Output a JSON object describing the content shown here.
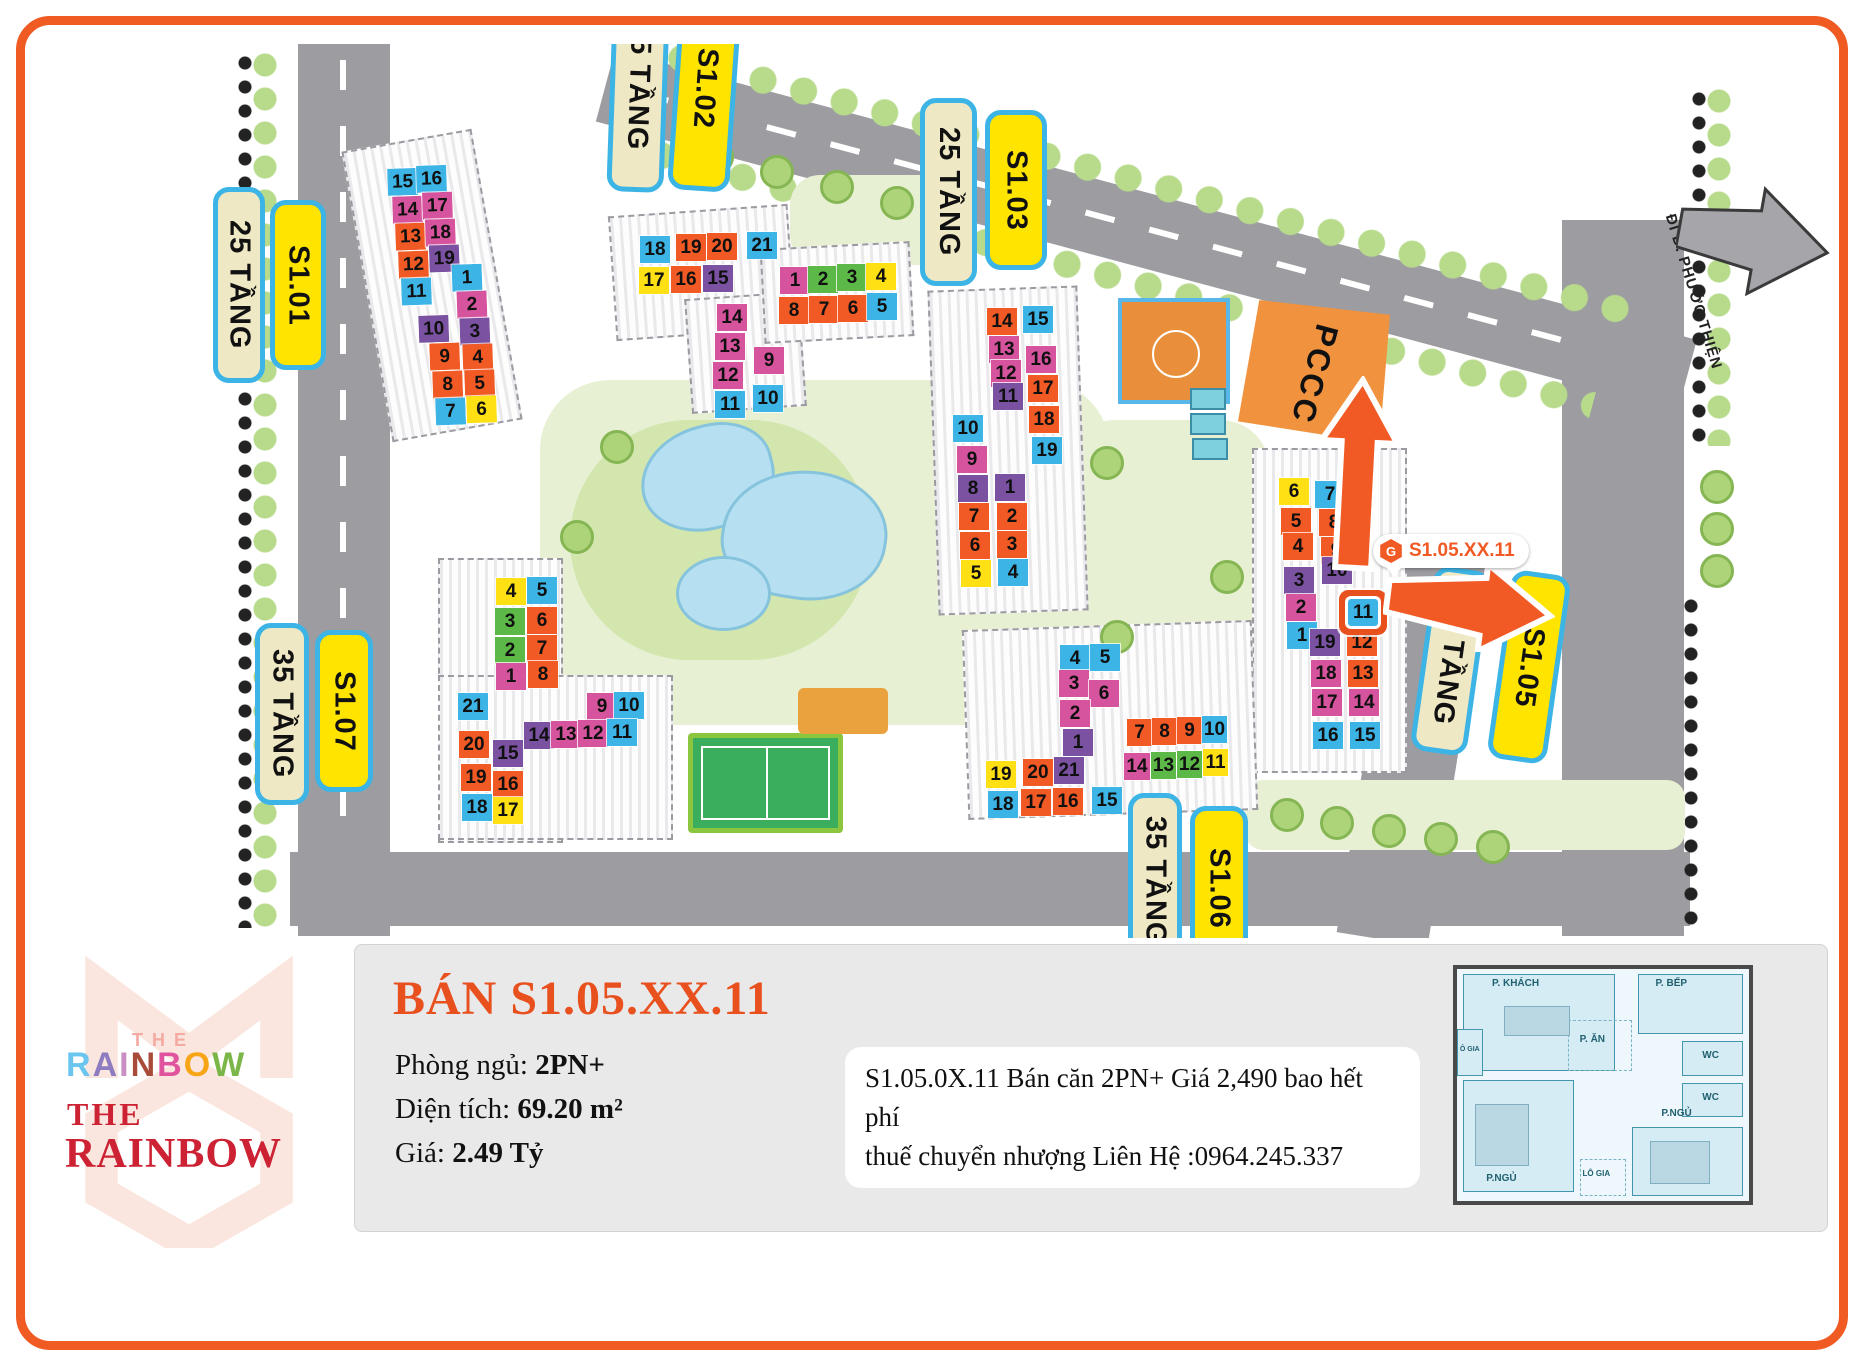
{
  "colors": {
    "O": "#f15a24",
    "P": "#d6549e",
    "U": "#7a52a1",
    "C": "#3cb4e5",
    "Y": "#ffe014",
    "G": "#5cb947",
    "accent": "#e8501e",
    "frame": "#f05a23",
    "label_border": "#3cb4e5",
    "label_yellow": "#ffe400",
    "label_cream": "#efe8c4"
  },
  "map": {
    "pccc_label": "PCCC",
    "road_sign": "ĐI Đ. PHƯỚC THIỆN",
    "unit_tag": {
      "icon": "hexagon-logo-icon",
      "text": "S1.05.XX.11"
    },
    "labels": [
      {
        "text": "25 TẦNG",
        "type": "cream",
        "x": 213,
        "y": 187,
        "w": 52,
        "h": 196,
        "rot": 0
      },
      {
        "text": "S1.01",
        "type": "yellow",
        "x": 270,
        "y": 200,
        "w": 56,
        "h": 170,
        "rot": 0
      },
      {
        "text": "25 TẦNG",
        "type": "cream",
        "x": 610,
        "y": -20,
        "w": 57,
        "h": 212,
        "rot": 2
      },
      {
        "text": "S1.02",
        "type": "yellow",
        "x": 674,
        "y": -15,
        "w": 62,
        "h": 206,
        "rot": 4
      },
      {
        "text": "25 TẦNG",
        "type": "cream",
        "x": 920,
        "y": 98,
        "w": 57,
        "h": 188,
        "rot": 0
      },
      {
        "text": "S1.03",
        "type": "yellow",
        "x": 985,
        "y": 110,
        "w": 62,
        "h": 160,
        "rot": 0
      },
      {
        "text": "35 TẦNG",
        "type": "cream",
        "x": 255,
        "y": 623,
        "w": 54,
        "h": 182,
        "rot": 0
      },
      {
        "text": "S1.07",
        "type": "yellow",
        "x": 315,
        "y": 630,
        "w": 58,
        "h": 162,
        "rot": 0
      },
      {
        "text": "25 TẦNG",
        "type": "cream",
        "x": 1422,
        "y": 568,
        "w": 57,
        "h": 186,
        "rot": 8
      },
      {
        "text": "S1.05",
        "type": "yellow",
        "x": 1499,
        "y": 572,
        "w": 60,
        "h": 190,
        "rot": 8
      },
      {
        "text": "35 TẦNG",
        "type": "cream",
        "x": 1128,
        "y": 793,
        "w": 54,
        "h": 175,
        "rot": 0
      },
      {
        "text": "S1.06",
        "type": "yellow",
        "x": 1190,
        "y": 806,
        "w": 58,
        "h": 165,
        "rot": 0
      }
    ],
    "buildings": [
      {
        "id": "s101",
        "x": 385,
        "y": 165,
        "rot": -2,
        "cells": [
          {
            "n": "15",
            "x": 2,
            "y": 4,
            "c": "C"
          },
          {
            "n": "16",
            "x": 31,
            "y": 2,
            "c": "C"
          },
          {
            "n": "14",
            "x": 6,
            "y": 32,
            "c": "P"
          },
          {
            "n": "17",
            "x": 36,
            "y": 29,
            "c": "P"
          },
          {
            "n": "13",
            "x": 8,
            "y": 59,
            "c": "O"
          },
          {
            "n": "18",
            "x": 38,
            "y": 56,
            "c": "P"
          },
          {
            "n": "12",
            "x": 10,
            "y": 87,
            "c": "O"
          },
          {
            "n": "19",
            "x": 41,
            "y": 82,
            "c": "U"
          },
          {
            "n": "11",
            "x": 12,
            "y": 114,
            "c": "C"
          },
          {
            "n": "1",
            "x": 63,
            "y": 102,
            "c": "C"
          },
          {
            "n": "2",
            "x": 67,
            "y": 129,
            "c": "P"
          },
          {
            "n": "10",
            "x": 28,
            "y": 152,
            "c": "U"
          },
          {
            "n": "3",
            "x": 69,
            "y": 156,
            "c": "U"
          },
          {
            "n": "9",
            "x": 38,
            "y": 180,
            "c": "O"
          },
          {
            "n": "4",
            "x": 71,
            "y": 182,
            "c": "O"
          },
          {
            "n": "8",
            "x": 40,
            "y": 208,
            "c": "O"
          },
          {
            "n": "5",
            "x": 72,
            "y": 208,
            "c": "O"
          },
          {
            "n": "7",
            "x": 42,
            "y": 235,
            "c": "C"
          },
          {
            "n": "6",
            "x": 73,
            "y": 234,
            "c": "Y"
          }
        ]
      },
      {
        "id": "s102",
        "x": 639,
        "y": 232,
        "rot": 0,
        "cells": [
          {
            "n": "18",
            "x": 1,
            "y": 4,
            "c": "C"
          },
          {
            "n": "19",
            "x": 37,
            "y": 2,
            "c": "O"
          },
          {
            "n": "20",
            "x": 68,
            "y": 1,
            "c": "O"
          },
          {
            "n": "21",
            "x": 108,
            "y": 0,
            "c": "C"
          },
          {
            "n": "17",
            "x": 0,
            "y": 35,
            "c": "Y"
          },
          {
            "n": "16",
            "x": 32,
            "y": 34,
            "c": "O"
          },
          {
            "n": "15",
            "x": 64,
            "y": 33,
            "c": "U"
          },
          {
            "n": "14",
            "x": 78,
            "y": 72,
            "c": "P"
          },
          {
            "n": "13",
            "x": 76,
            "y": 101,
            "c": "P"
          },
          {
            "n": "12",
            "x": 74,
            "y": 130,
            "c": "P"
          },
          {
            "n": "11",
            "x": 76,
            "y": 159,
            "c": "C"
          },
          {
            "n": "9",
            "x": 115,
            "y": 115,
            "c": "P"
          },
          {
            "n": "10",
            "x": 114,
            "y": 153,
            "c": "C"
          }
        ]
      },
      {
        "id": "s103",
        "x": 778,
        "y": 263,
        "rot": 0,
        "cells": [
          {
            "n": "1",
            "x": 2,
            "y": 4,
            "c": "P"
          },
          {
            "n": "2",
            "x": 30,
            "y": 3,
            "c": "G"
          },
          {
            "n": "3",
            "x": 59,
            "y": 1,
            "c": "G"
          },
          {
            "n": "4",
            "x": 88,
            "y": 0,
            "c": "Y"
          },
          {
            "n": "8",
            "x": 1,
            "y": 34,
            "c": "O"
          },
          {
            "n": "7",
            "x": 31,
            "y": 33,
            "c": "O"
          },
          {
            "n": "6",
            "x": 60,
            "y": 32,
            "c": "O"
          },
          {
            "n": "5",
            "x": 89,
            "y": 30,
            "c": "C"
          }
        ]
      },
      {
        "id": "s104",
        "x": 950,
        "y": 305,
        "rot": 0,
        "cells": [
          {
            "n": "14",
            "x": 37,
            "y": 3,
            "c": "O"
          },
          {
            "n": "15",
            "x": 73,
            "y": 1,
            "c": "C"
          },
          {
            "n": "13",
            "x": 39,
            "y": 31,
            "c": "P"
          },
          {
            "n": "16",
            "x": 76,
            "y": 41,
            "c": "P"
          },
          {
            "n": "12",
            "x": 41,
            "y": 55,
            "c": "P"
          },
          {
            "n": "17",
            "x": 78,
            "y": 70,
            "c": "O"
          },
          {
            "n": "11",
            "x": 43,
            "y": 78,
            "c": "U"
          },
          {
            "n": "18",
            "x": 79,
            "y": 101,
            "c": "O"
          },
          {
            "n": "19",
            "x": 82,
            "y": 132,
            "c": "C"
          },
          {
            "n": "10",
            "x": 3,
            "y": 110,
            "c": "C"
          },
          {
            "n": "9",
            "x": 7,
            "y": 141,
            "c": "P"
          },
          {
            "n": "8",
            "x": 8,
            "y": 170,
            "c": "U"
          },
          {
            "n": "1",
            "x": 45,
            "y": 169,
            "c": "U"
          },
          {
            "n": "7",
            "x": 9,
            "y": 198,
            "c": "O"
          },
          {
            "n": "2",
            "x": 47,
            "y": 198,
            "c": "O"
          },
          {
            "n": "6",
            "x": 10,
            "y": 227,
            "c": "O"
          },
          {
            "n": "3",
            "x": 47,
            "y": 226,
            "c": "O"
          },
          {
            "n": "5",
            "x": 11,
            "y": 255,
            "c": "Y"
          },
          {
            "n": "4",
            "x": 48,
            "y": 254,
            "c": "C"
          }
        ]
      },
      {
        "id": "s105",
        "x": 1269,
        "y": 465,
        "rot": 0,
        "cells": [
          {
            "n": "6",
            "x": 10,
            "y": 13,
            "c": "Y"
          },
          {
            "n": "7",
            "x": 46,
            "y": 16,
            "c": "C"
          },
          {
            "n": "5",
            "x": 12,
            "y": 43,
            "c": "O"
          },
          {
            "n": "8",
            "x": 50,
            "y": 44,
            "c": "O"
          },
          {
            "n": "4",
            "x": 14,
            "y": 68,
            "c": "O"
          },
          {
            "n": "9",
            "x": 52,
            "y": 72,
            "c": "O"
          },
          {
            "n": "3",
            "x": 15,
            "y": 102,
            "c": "U"
          },
          {
            "n": "10",
            "x": 53,
            "y": 92,
            "c": "U"
          },
          {
            "n": "2",
            "x": 17,
            "y": 129,
            "c": "P"
          },
          {
            "n": "11",
            "x": 79,
            "y": 134,
            "c": "C",
            "hl": true
          },
          {
            "n": "1",
            "x": 18,
            "y": 157,
            "c": "C"
          },
          {
            "n": "19",
            "x": 41,
            "y": 164,
            "c": "U"
          },
          {
            "n": "12",
            "x": 78,
            "y": 164,
            "c": "O"
          },
          {
            "n": "18",
            "x": 42,
            "y": 195,
            "c": "P"
          },
          {
            "n": "13",
            "x": 79,
            "y": 195,
            "c": "O"
          },
          {
            "n": "17",
            "x": 43,
            "y": 224,
            "c": "P"
          },
          {
            "n": "14",
            "x": 80,
            "y": 224,
            "c": "P"
          },
          {
            "n": "16",
            "x": 44,
            "y": 257,
            "c": "C"
          },
          {
            "n": "15",
            "x": 81,
            "y": 257,
            "c": "C"
          }
        ]
      },
      {
        "id": "s106",
        "x": 985,
        "y": 640,
        "rot": 0,
        "cells": [
          {
            "n": "4",
            "x": 75,
            "y": 5,
            "c": "C"
          },
          {
            "n": "5",
            "x": 105,
            "y": 4,
            "c": "C"
          },
          {
            "n": "3",
            "x": 74,
            "y": 30,
            "c": "P"
          },
          {
            "n": "6",
            "x": 104,
            "y": 40,
            "c": "P"
          },
          {
            "n": "2",
            "x": 75,
            "y": 60,
            "c": "P"
          },
          {
            "n": "1",
            "x": 78,
            "y": 89,
            "c": "U"
          },
          {
            "n": "19",
            "x": 1,
            "y": 121,
            "c": "Y"
          },
          {
            "n": "20",
            "x": 38,
            "y": 119,
            "c": "O"
          },
          {
            "n": "21",
            "x": 69,
            "y": 117,
            "c": "U"
          },
          {
            "n": "18",
            "x": 3,
            "y": 151,
            "c": "C"
          },
          {
            "n": "17",
            "x": 36,
            "y": 149,
            "c": "O"
          },
          {
            "n": "16",
            "x": 68,
            "y": 148,
            "c": "O"
          },
          {
            "n": "15",
            "x": 107,
            "y": 147,
            "c": "C"
          },
          {
            "n": "7",
            "x": 142,
            "y": 79,
            "c": "O",
            "w": 25
          },
          {
            "n": "8",
            "x": 167,
            "y": 78,
            "c": "O",
            "w": 25
          },
          {
            "n": "9",
            "x": 192,
            "y": 77,
            "c": "O",
            "w": 25
          },
          {
            "n": "10",
            "x": 217,
            "y": 76,
            "c": "C",
            "w": 25
          },
          {
            "n": "14",
            "x": 139,
            "y": 113,
            "c": "P",
            "w": 26
          },
          {
            "n": "13",
            "x": 166,
            "y": 112,
            "c": "G",
            "w": 25
          },
          {
            "n": "12",
            "x": 192,
            "y": 111,
            "c": "G",
            "w": 25
          },
          {
            "n": "11",
            "x": 218,
            "y": 109,
            "c": "Y",
            "w": 25
          }
        ]
      },
      {
        "id": "s107",
        "x": 455,
        "y": 575,
        "rot": 0,
        "cells": [
          {
            "n": "4",
            "x": 41,
            "y": 3,
            "c": "Y"
          },
          {
            "n": "5",
            "x": 72,
            "y": 2,
            "c": "C"
          },
          {
            "n": "3",
            "x": 40,
            "y": 33,
            "c": "G"
          },
          {
            "n": "6",
            "x": 72,
            "y": 32,
            "c": "O"
          },
          {
            "n": "2",
            "x": 40,
            "y": 62,
            "c": "G"
          },
          {
            "n": "7",
            "x": 72,
            "y": 60,
            "c": "O"
          },
          {
            "n": "1",
            "x": 41,
            "y": 88,
            "c": "P"
          },
          {
            "n": "8",
            "x": 73,
            "y": 86,
            "c": "O"
          },
          {
            "n": "21",
            "x": 3,
            "y": 118,
            "c": "C"
          },
          {
            "n": "20",
            "x": 4,
            "y": 156,
            "c": "O"
          },
          {
            "n": "15",
            "x": 38,
            "y": 165,
            "c": "U"
          },
          {
            "n": "19",
            "x": 6,
            "y": 189,
            "c": "O"
          },
          {
            "n": "16",
            "x": 38,
            "y": 196,
            "c": "O"
          },
          {
            "n": "18",
            "x": 7,
            "y": 219,
            "c": "C"
          },
          {
            "n": "17",
            "x": 38,
            "y": 222,
            "c": "Y"
          },
          {
            "n": "9",
            "x": 132,
            "y": 118,
            "c": "P"
          },
          {
            "n": "10",
            "x": 159,
            "y": 117,
            "c": "C"
          },
          {
            "n": "14",
            "x": 69,
            "y": 147,
            "c": "U"
          },
          {
            "n": "13",
            "x": 96,
            "y": 146,
            "c": "P"
          },
          {
            "n": "12",
            "x": 123,
            "y": 145,
            "c": "P"
          },
          {
            "n": "11",
            "x": 152,
            "y": 144,
            "c": "C"
          }
        ]
      }
    ]
  },
  "panel": {
    "title": "BÁN S1.05.XX.11",
    "bedrooms_label": "Phòng ngủ: ",
    "bedrooms_value": "2PN+",
    "area_label": "Diện tích: ",
    "area_value": "69.20 m²",
    "price_label": "Giá: ",
    "price_value": "2.49 Tỷ",
    "note_line1": "S1.05.0X.11 Bán căn 2PN+ Giá 2,490 bao hết phí",
    "note_line2": "thuế chuyển nhượng Liên Hệ :0964.245.337"
  },
  "logo": {
    "the_small": "THE",
    "rainbow_letters": [
      {
        "ch": "R",
        "c": "#6cc5ef"
      },
      {
        "ch": "A",
        "c": "#8f7cc0"
      },
      {
        "ch": "I",
        "c": "#c98fc4"
      },
      {
        "ch": "N",
        "c": "#a84b38"
      },
      {
        "ch": "B",
        "c": "#e0549e"
      },
      {
        "ch": "O",
        "c": "#f7a516"
      },
      {
        "ch": "W",
        "c": "#7ab648"
      }
    ],
    "the_big": "THE",
    "rainbow_big": "RAINBOW"
  },
  "floorplan": {
    "living": "P. KHÁCH",
    "kitchen": "P. BẾP",
    "dining": "P. ĂN",
    "loggia_left": "Ô GIA",
    "wc1": "WC",
    "wc2": "WC",
    "bed1": "P.NGỦ",
    "bed2": "P.NGỦ",
    "loggia": "LÔ GIA"
  }
}
